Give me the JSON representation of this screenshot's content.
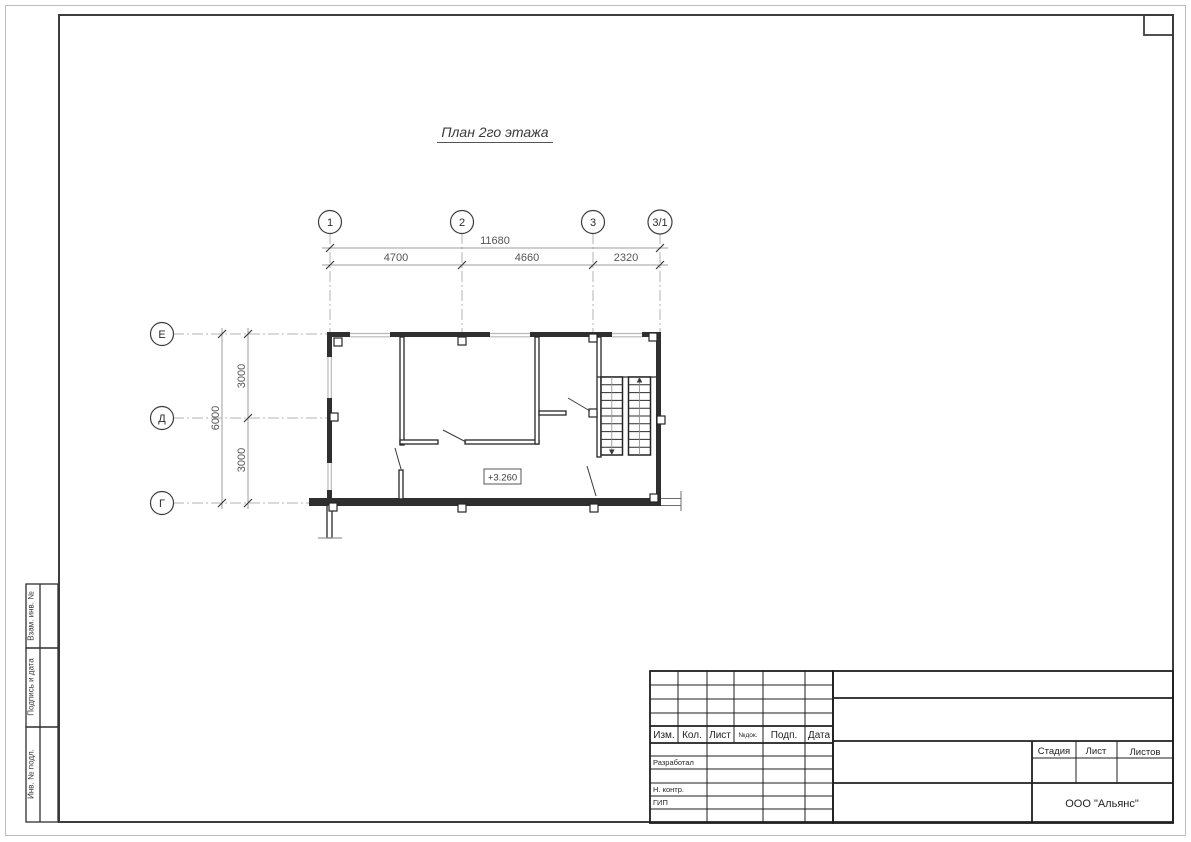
{
  "drawing": {
    "title": "План 2го этажа",
    "elevation": "+3.260"
  },
  "axes": {
    "top": [
      "1",
      "2",
      "3",
      "3/1"
    ],
    "left": [
      "Е",
      "Д",
      "Г"
    ]
  },
  "dims": {
    "total_h": "11680",
    "spans_h": [
      "4700",
      "4660",
      "2320"
    ],
    "total_v": "6000",
    "spans_v": [
      "3000",
      "3000"
    ]
  },
  "stamp": {
    "header": [
      "Изм.",
      "Кол.",
      "Лист",
      "№док.",
      "Подп.",
      "Дата"
    ],
    "roles": [
      "Разработал",
      "Н. контр.",
      "ГИП"
    ],
    "stage_cols": [
      "Стадия",
      "Лист",
      "Листов"
    ],
    "company": "ООО \"Альянс\""
  },
  "margin_labels": [
    "Взам. инв. №",
    "Подпись и дата",
    "Инв. № подл."
  ]
}
